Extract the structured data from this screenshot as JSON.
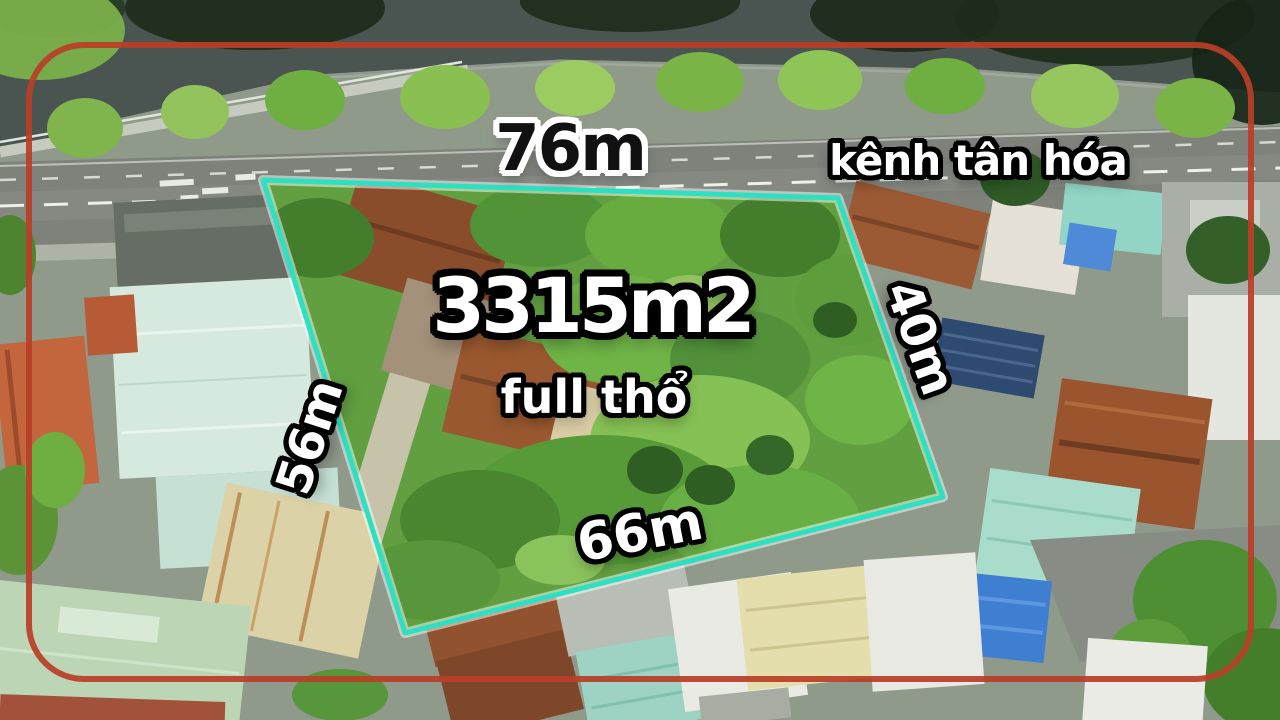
{
  "plot": {
    "area_label": "3315m2",
    "status_label": "full thổ",
    "measurements": {
      "top": "76m",
      "left": "56m",
      "right": "40m",
      "bottom": "66m"
    }
  },
  "location": {
    "canal_name": "kênh tân hóa"
  },
  "colors": {
    "boundary_line": "#2de0c2",
    "frame_border": "#b8402e",
    "measurement_text": "#ffffff",
    "measurement_outline": "#000000",
    "top_measurement_text": "#111111",
    "top_measurement_outline": "#ffffff",
    "canal_water": "#4a5450",
    "road": "#7e827b"
  }
}
